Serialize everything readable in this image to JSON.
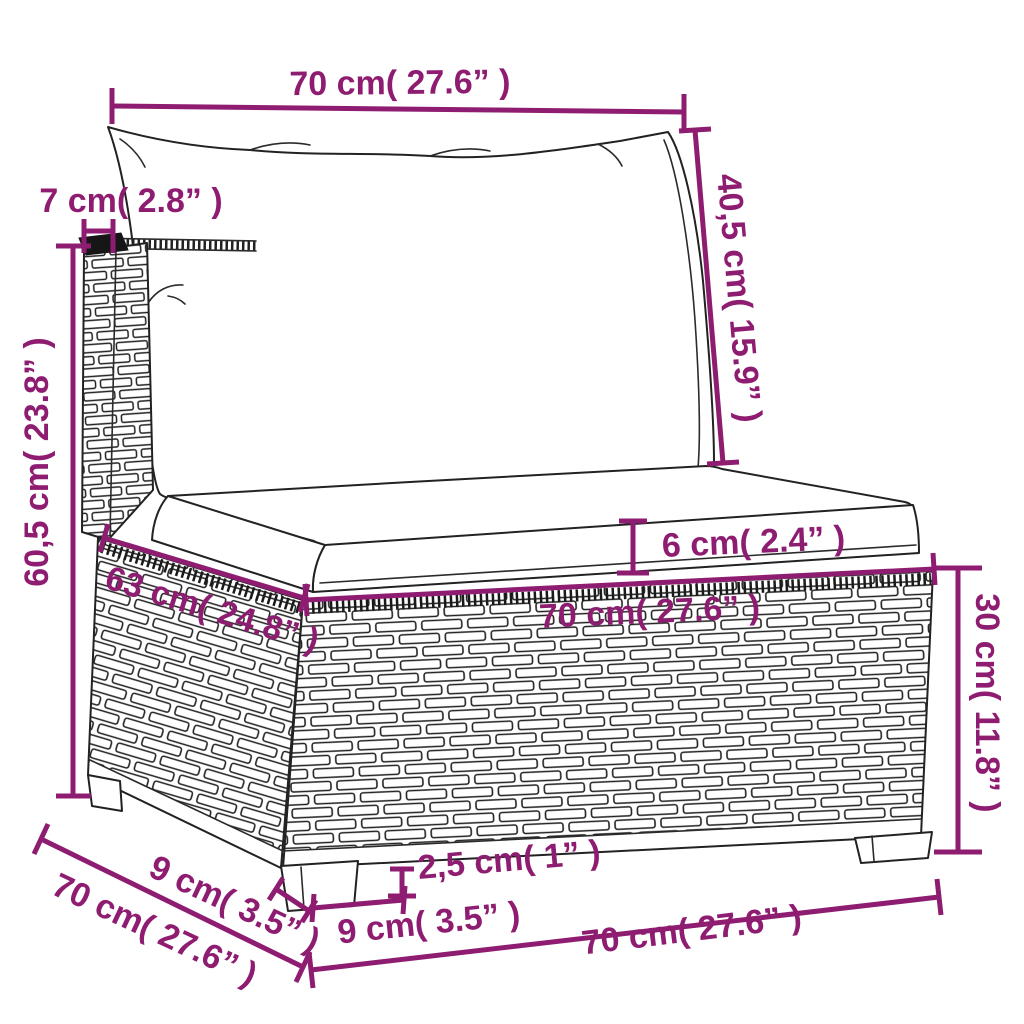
{
  "diagram": {
    "colors": {
      "dimension_accent": "#8e1d71",
      "drawing_outline": "#222222",
      "background": "#ffffff"
    },
    "labels": {
      "top_width": "70 cm( 27.6” )",
      "backrest_thickness": "7 cm( 2.8” )",
      "overall_height": "60,5 cm( 23.8” )",
      "back_cushion_height": "40,5 cm( 15.9” )",
      "seat_thickness": "6 cm( 2.4” )",
      "seat_width": "70 cm( 27.6” )",
      "seat_depth": "63 cm( 24.8” )",
      "base_height": "30 cm( 11.8” )",
      "side_leg_width": "9 cm( 3.5” )",
      "side_depth": "70 cm( 27.6” )",
      "front_leg_width": "9 cm( 3.5” )",
      "front_width": "70 cm( 27.6” )",
      "leg_height": "2,5 cm( 1” )"
    }
  }
}
